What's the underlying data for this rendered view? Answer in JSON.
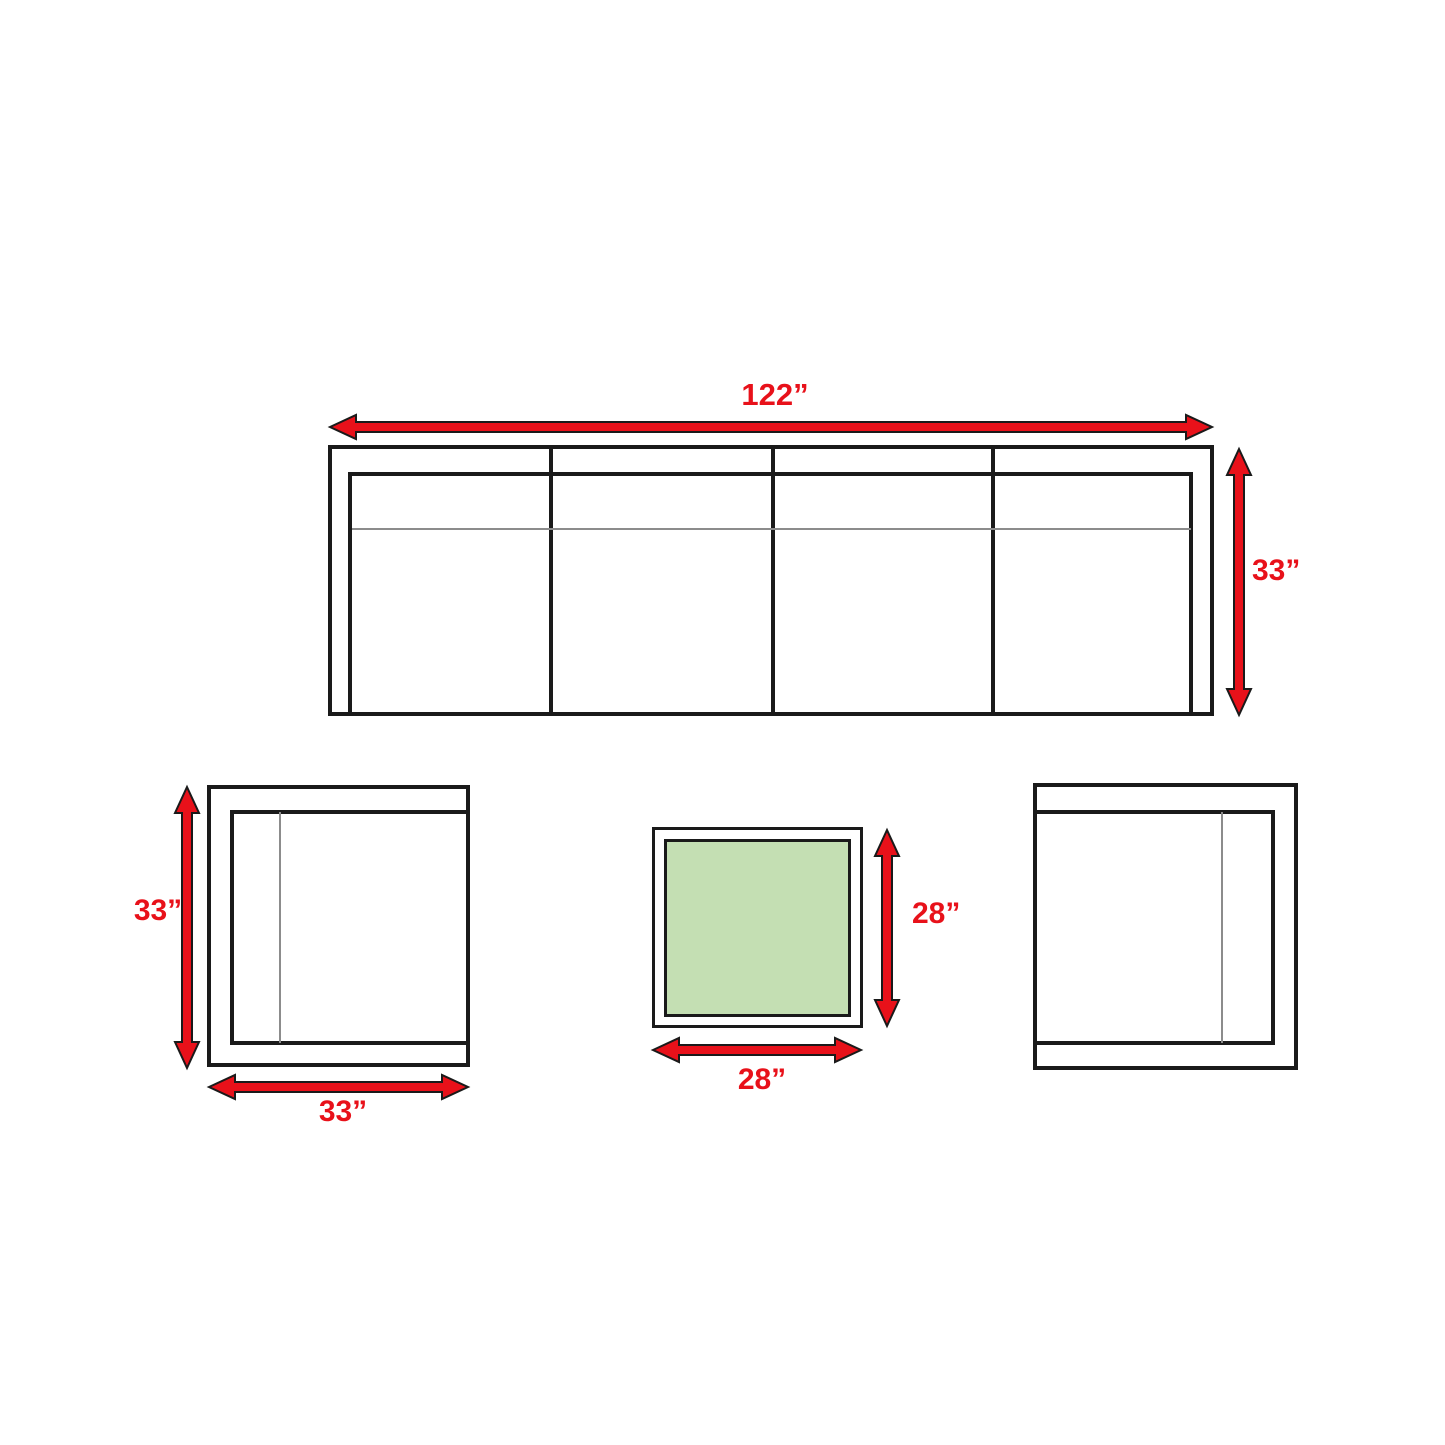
{
  "diagram_title": "outdoor furniture set dimensions (top view)",
  "colors": {
    "arrow_red": "#e8111a",
    "table_green": "#c4dfb3",
    "outline_black": "#1a1a1a",
    "cushion_gray": "#8c8c8c"
  },
  "sofa": {
    "width_label": "122”",
    "height_label": "33”",
    "sections": 4
  },
  "chair_left": {
    "height_label": "33”",
    "width_label": "33”"
  },
  "coffee_table": {
    "height_label": "28”",
    "width_label": "28”"
  },
  "chair_right": {}
}
